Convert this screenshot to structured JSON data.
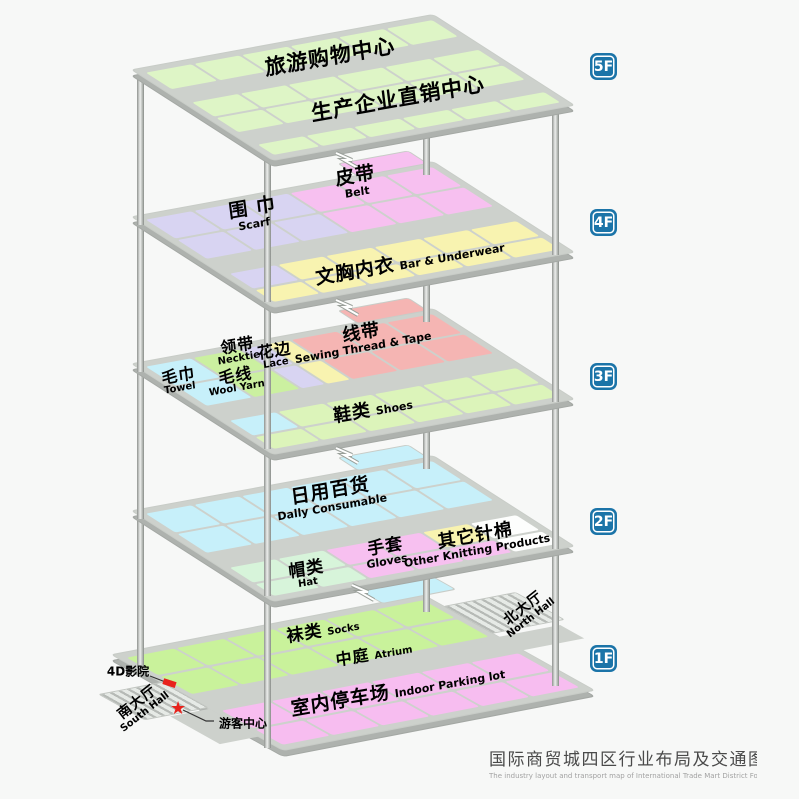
{
  "title": {
    "zh": "国际商贸城四区行业布局及交通图",
    "en": "The industry layout and transport map of International Trade Mart District Four"
  },
  "badges": {
    "f5": "5F",
    "f4": "4F",
    "f3": "3F",
    "f2": "2F",
    "f1": "1F"
  },
  "floors": {
    "f5": {
      "tourism": {
        "zh": "旅游购物中心"
      },
      "direct": {
        "zh": "生产企业直销中心"
      }
    },
    "f4": {
      "scarf": {
        "zh": "围 巾",
        "en": "Scarf"
      },
      "belt": {
        "zh": "皮带",
        "en": "Belt"
      },
      "bra": {
        "zh": "文胸内衣",
        "en": "Bar & Underwear"
      }
    },
    "f3": {
      "towel": {
        "zh": "毛巾",
        "en": "Towel"
      },
      "necktie": {
        "zh": "领带",
        "en": "Necktie"
      },
      "wool": {
        "zh": "毛线",
        "en": "Wool Yarn"
      },
      "lace": {
        "zh": "花边",
        "en": "Lace"
      },
      "thread": {
        "zh": "线带",
        "en": "Sewing Thread & Tape"
      },
      "shoes": {
        "zh": "鞋类",
        "en": "Shoes"
      }
    },
    "f2": {
      "daily": {
        "zh": "日用百货",
        "en": "Dally Consumable"
      },
      "hat": {
        "zh": "帽类",
        "en": "Hat"
      },
      "gloves": {
        "zh": "手套",
        "en": "Gloves"
      },
      "knitting": {
        "zh": "其它针棉",
        "en": "Other Knitting Products"
      }
    },
    "f1": {
      "socks": {
        "zh": "袜类",
        "en": "Socks"
      },
      "atrium": {
        "zh": "中庭",
        "en": "Atrium"
      },
      "parking": {
        "zh": "室内停车场",
        "en": "Indoor Parking lot"
      },
      "north": {
        "zh": "北大厅",
        "en": "North Hall"
      },
      "south": {
        "zh": "南大厅",
        "en": "South Hall"
      },
      "cinema": {
        "zh": "4D影院"
      },
      "tourist": {
        "zh": "游客中心"
      }
    }
  },
  "colors": {
    "floor5_green": "#def5c6",
    "lavender": "#d8d4f2",
    "pink": "#f7c0f0",
    "yellow": "#f8f3b0",
    "cyan": "#c7f0fa",
    "red": "#f5b5b3",
    "green": "#cbf0a0",
    "mint": "#d7f4da",
    "bright_green": "#c9f29b",
    "white": "#fdfefd",
    "shoes_green": "#dcf4ba",
    "corridor_gray": "#cdd1cc",
    "badge_blue": "#1b74a8",
    "marker_red": "#e8221c"
  }
}
